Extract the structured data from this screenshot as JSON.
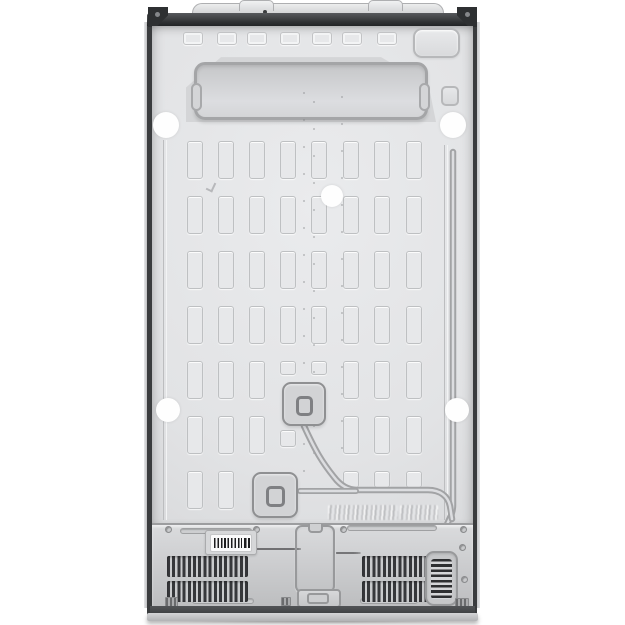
{
  "scene": {
    "description": "Rear view product photo of a side-by-side refrigerator: embossed sheet-metal back panel, refrigerant pipe channel, access covers, compressor compartment with vent grilles, barcode label and illegible fine-print labels, on a plain white background",
    "background": "#ffffff"
  },
  "palette": {
    "panel": "#e2e3e5",
    "panel_shade": "#cfd0d2",
    "trim_dark": "#3a3c3e",
    "base": "#46484a",
    "plinth": "#c6c7c9",
    "vent_slat": "#36373a",
    "emboss_line": "#98999b",
    "white_cap": "#fefefe"
  },
  "top_rect_row": {
    "xs": [
      183,
      217,
      247,
      280,
      312,
      342,
      377
    ],
    "y": 32,
    "w": 20,
    "h": 13
  },
  "grid": {
    "col_x": [
      187,
      218,
      249,
      280,
      311,
      343,
      374,
      406
    ],
    "row_y": [
      141,
      196,
      251,
      306,
      361,
      416,
      471
    ],
    "slot_w": 16,
    "slot_h": 38,
    "overrides": {
      "4": {
        "3": {
          "h": 14
        },
        "4": {
          "h": 14
        }
      },
      "5": {
        "3": {
          "y": 430,
          "h": 17
        },
        "4": null
      },
      "6": {
        "2": null,
        "3": null,
        "4": null,
        "5": {
          "h": 17
        },
        "6": {
          "h": 17
        },
        "7": {
          "h": 17
        }
      }
    }
  },
  "white_caps": [
    {
      "cx": 166,
      "cy": 125,
      "r": 13
    },
    {
      "cx": 453,
      "cy": 125,
      "r": 13
    },
    {
      "cx": 332,
      "cy": 196,
      "r": 11
    },
    {
      "cx": 168,
      "cy": 410,
      "r": 12
    },
    {
      "cx": 457,
      "cy": 410,
      "r": 12
    }
  ],
  "weld_dots": {
    "cols": [
      303,
      313,
      341
    ],
    "y_start": 92,
    "y_end": 470,
    "step": 27
  },
  "vents": {
    "left_x": 167,
    "right_x": 362,
    "rows_y": [
      556,
      581
    ],
    "w": 81,
    "h": 21
  },
  "fine_print": {
    "center_lines": [
      30,
      40,
      36,
      44,
      42,
      38,
      44,
      40,
      34,
      28
    ],
    "right_lines": [
      20,
      24,
      22,
      25,
      18
    ]
  },
  "seam_screw_xs": [
    165,
    253,
    340,
    460
  ],
  "thin_slots": [
    {
      "x": 180,
      "y": 528,
      "w": 72
    },
    {
      "x": 347,
      "y": 525,
      "w": 90
    },
    {
      "x": 192,
      "y": 598,
      "w": 62
    },
    {
      "x": 360,
      "y": 598,
      "w": 58
    }
  ]
}
